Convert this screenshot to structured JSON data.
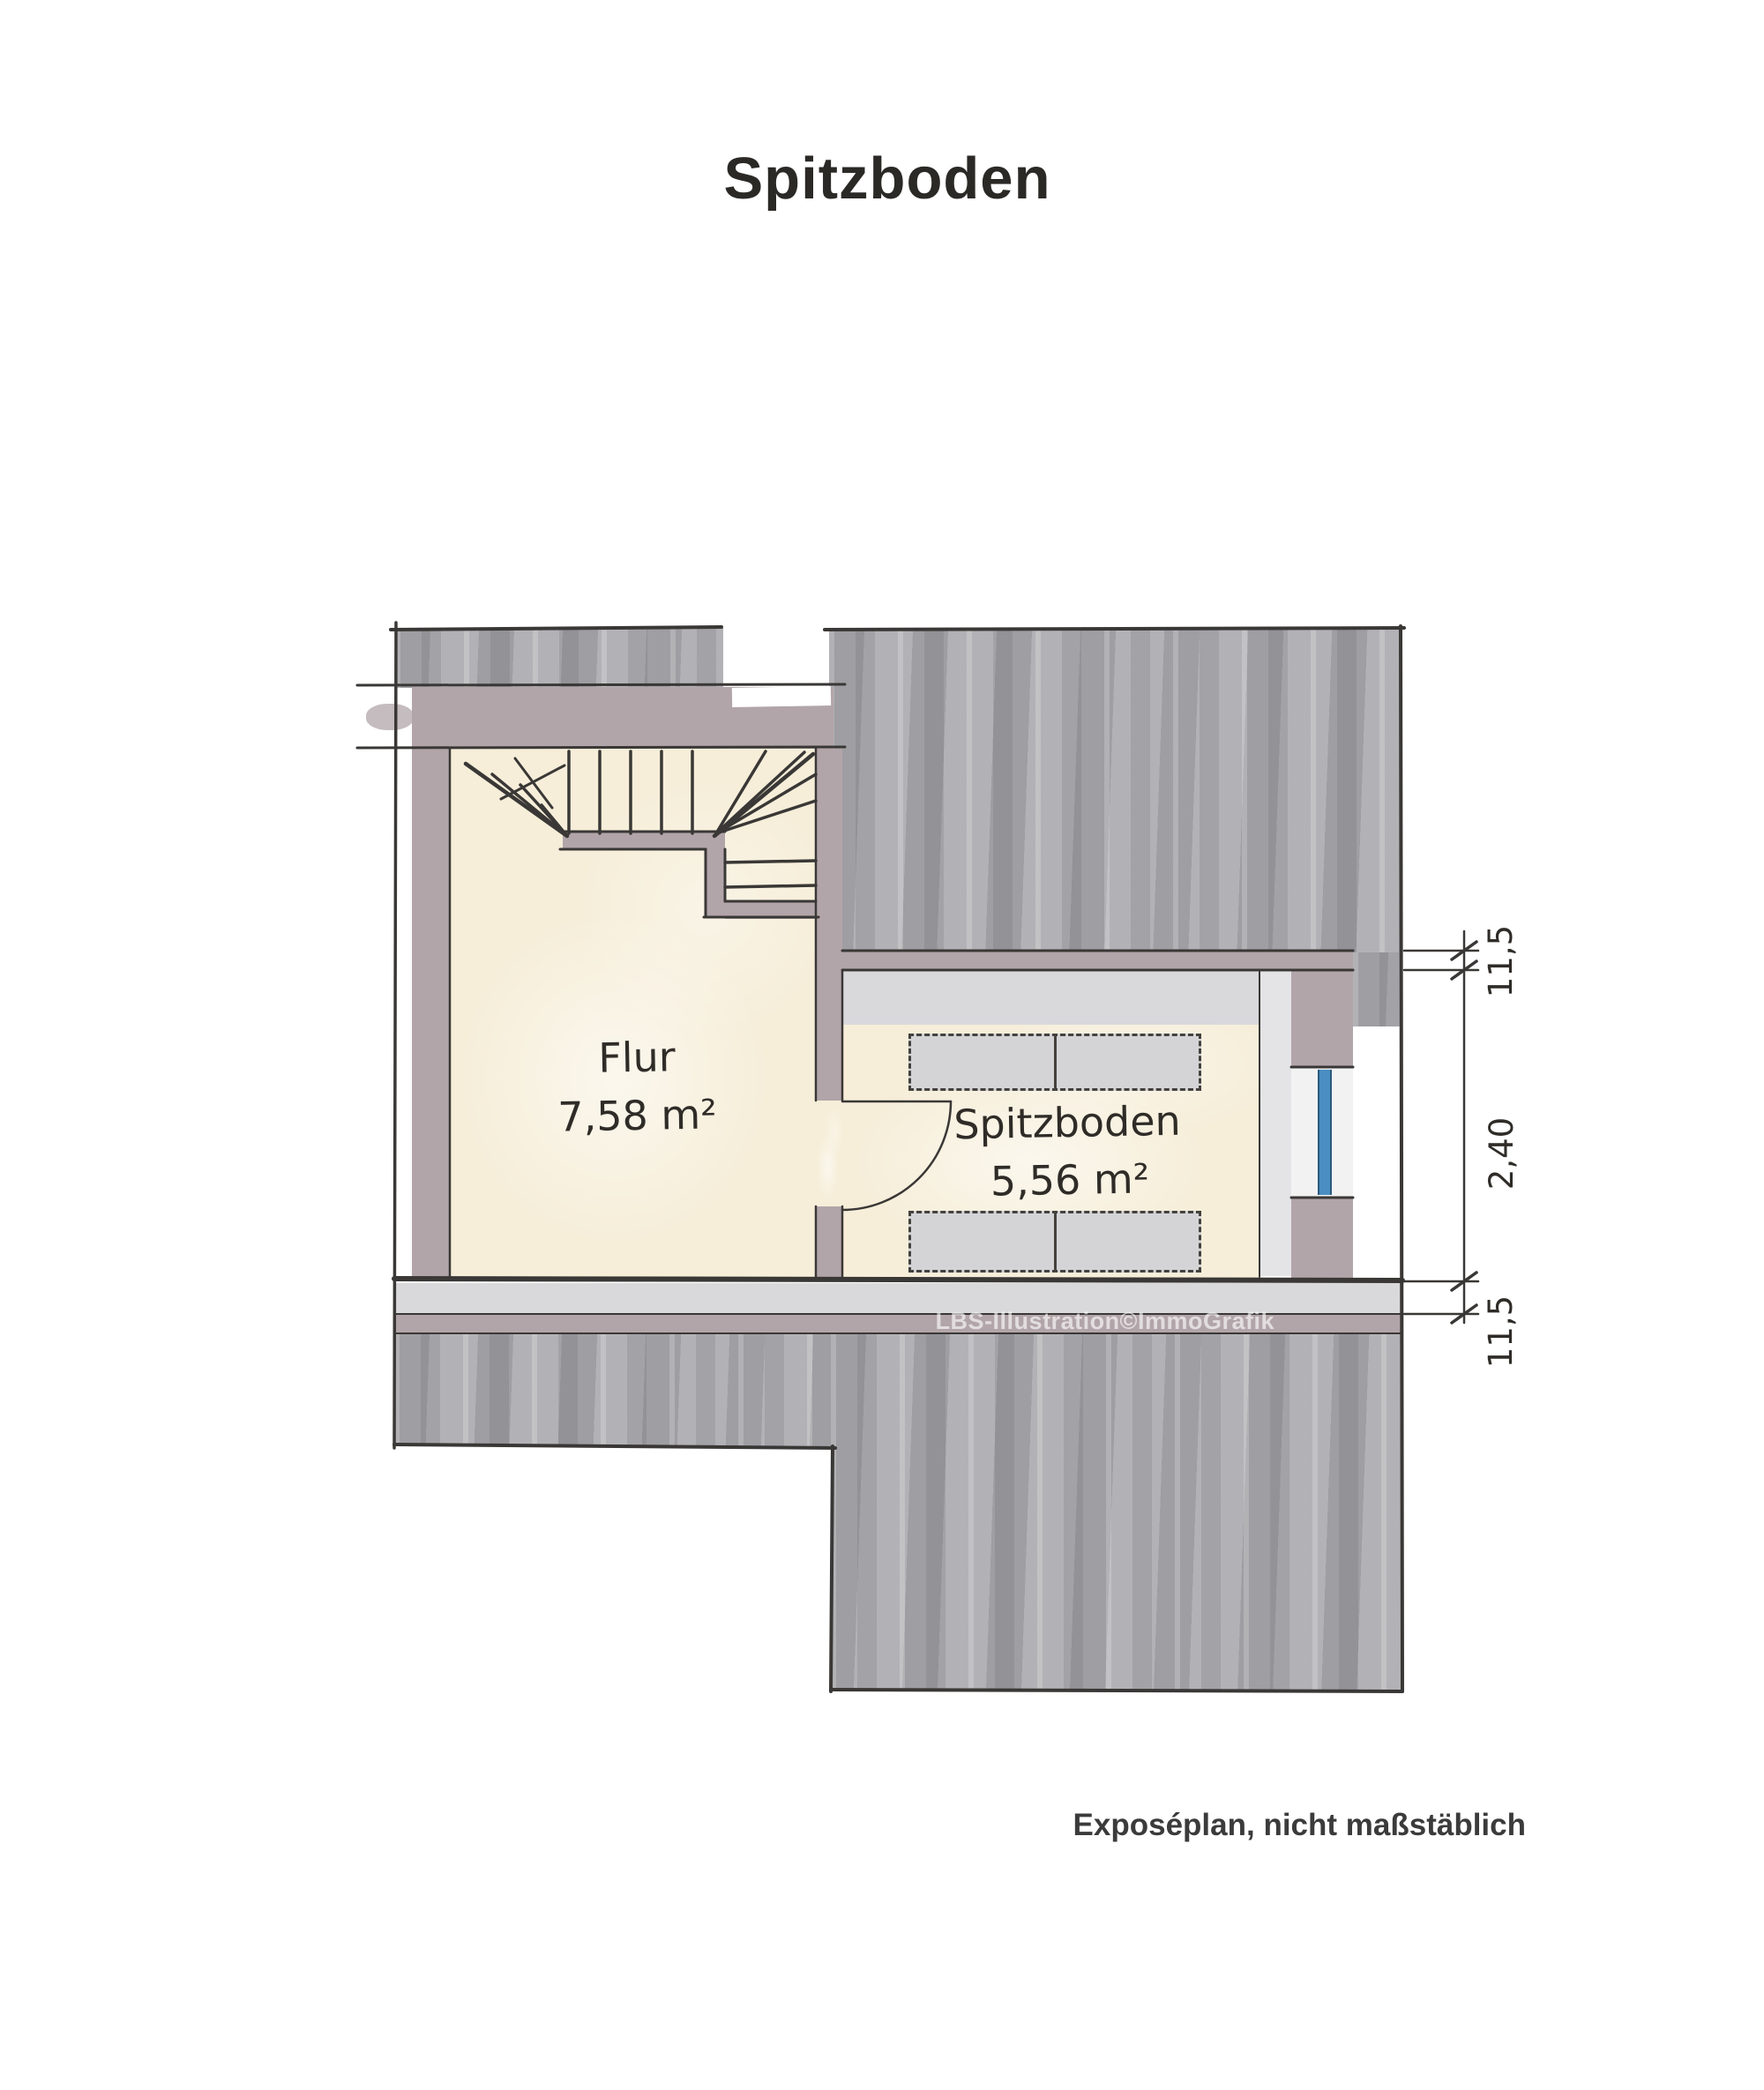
{
  "page": {
    "title": "Spitzboden",
    "footer_note": "Exposéplan, nicht maßstäblich",
    "watermark": "LBS-Illustration©ImmoGrafik"
  },
  "plan": {
    "type": "floor-plan",
    "floor": "Spitzboden (attic)",
    "rooms": [
      {
        "name": "Flur",
        "area": "7,58 m²"
      },
      {
        "name": "Spitzboden",
        "area": "5,56 m²"
      }
    ],
    "dimensions": {
      "top_wall_thickness": "11,5",
      "room_depth": "2,40",
      "bottom_wall_thickness": "11,5"
    },
    "features": [
      "winder-staircase",
      "door-swing",
      "window",
      "storage-boxes",
      "roof-wash-areas"
    ],
    "colors": {
      "roof_wash": "#a8a8ac",
      "wall": "#b2a5a9",
      "floor": "#f6eed9",
      "storage_fill": "#d4d4d7",
      "light_band": "#d9d9db",
      "window_blue": "#4a8ec2",
      "line": "#3a3836",
      "title_text": "#2b2926"
    }
  }
}
